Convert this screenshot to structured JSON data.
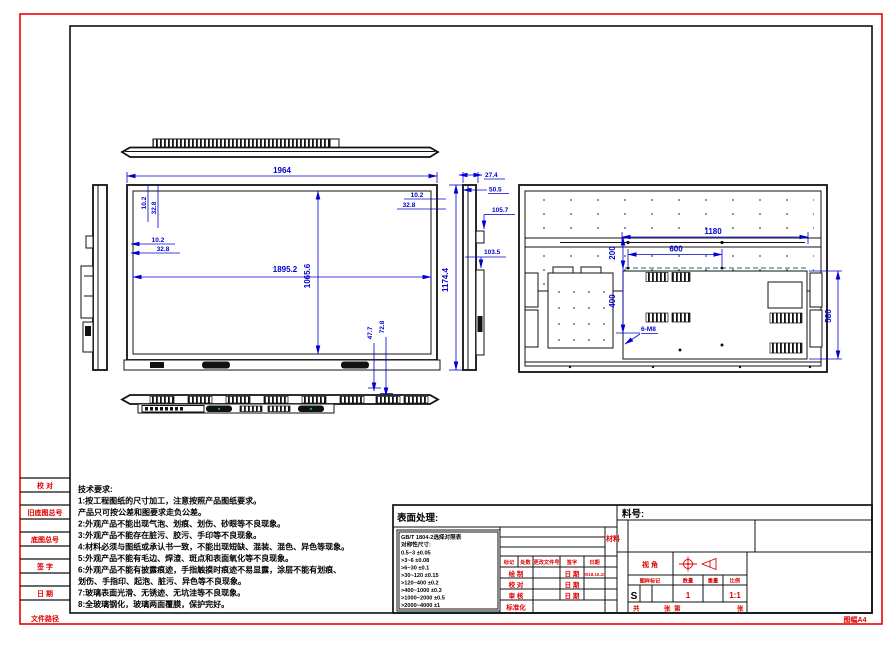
{
  "sheet": {
    "format_label": "图幅A4"
  },
  "margin_strip": {
    "labels": [
      "校 对",
      "旧底图总号",
      "底图总号",
      "签 字",
      "日 期",
      "文件路径"
    ]
  },
  "tech_requirements": {
    "title": "技术要求:",
    "lines": [
      "1:按工程图纸的尺寸加工，注意按照产品图纸要求。",
      "产品只可按公差和图要求走负公差。",
      "2:外观产品不能出现气泡、划痕、划伤、砂眼等不良现象。",
      "3:外观产品不能存在脏污、胶污、手印等不良现象。",
      "4:材料必须与图纸或承认书一致，不能出现短缺、混装、混色、异色等现象。",
      "5:外观产品不能有毛边、焊渣、斑点和表面氧化等不良现象。",
      "6:外观产品不能有披露痕迹，手指触摸时痕迹不易显露，涂层不能有划痕、",
      "划伤、手指印、起泡、脏污、异色等不良现象。",
      "7:玻璃表面光滑、无锈迹、无坑洼等不良现象。",
      "8:全玻璃钢化，玻璃两面覆膜，保护完好。"
    ]
  },
  "dims": {
    "front_width": "1964",
    "active_width": "1895.2",
    "active_height": "1065.6",
    "overall_height": "1174.4",
    "edge_offset_small": "10.2",
    "edge_offset_large": "32.8",
    "bottom_offset_small": "47.7",
    "bottom_offset_large": "72.8",
    "depth_front": "27.4",
    "depth_mid": "50.5",
    "depth_camera": "105.7",
    "depth_back": "103.5",
    "handle_span": "1180",
    "vesa_width": "600",
    "vesa_height": "400",
    "vesa_top_offset": "200",
    "plate_height": "580",
    "mount_holes": "6-M8"
  },
  "title_block": {
    "surface_label": "表面处理:",
    "part_no_label": "料号:",
    "material_label": "材料",
    "tolerance": {
      "title": "GB/T 1804-2选择对照表",
      "subtitle": "对称性尺寸:",
      "rows": [
        "0.5~3  ±0.05",
        ">3~6  ±0.08",
        ">6~30  ±0.1",
        ">30~120  ±0.15",
        ">120~400  ±0.2",
        ">400~1000  ±0.3",
        ">1000~2000  ±0.5",
        ">2000~4000  ±1"
      ]
    },
    "rev_headers": [
      "标记",
      "处数",
      "更改文件号",
      "签字",
      "日期"
    ],
    "rows": {
      "draw_label": "绘 制",
      "check_label": "校 对",
      "audit_label": "审 核",
      "std_label": "标准化",
      "date_label": "日 期",
      "draw_date": "2018.10.24"
    },
    "view_angle_label": "视 角",
    "spec_headers": [
      "图样标记",
      "数量",
      "重量",
      "比例"
    ],
    "spec": {
      "mark": "S",
      "qty": "1",
      "weight": "",
      "scale": "1:1"
    },
    "sheet_labels": {
      "total": "共",
      "sheet_a": "张",
      "page": "第",
      "sheet_b": "张"
    }
  }
}
